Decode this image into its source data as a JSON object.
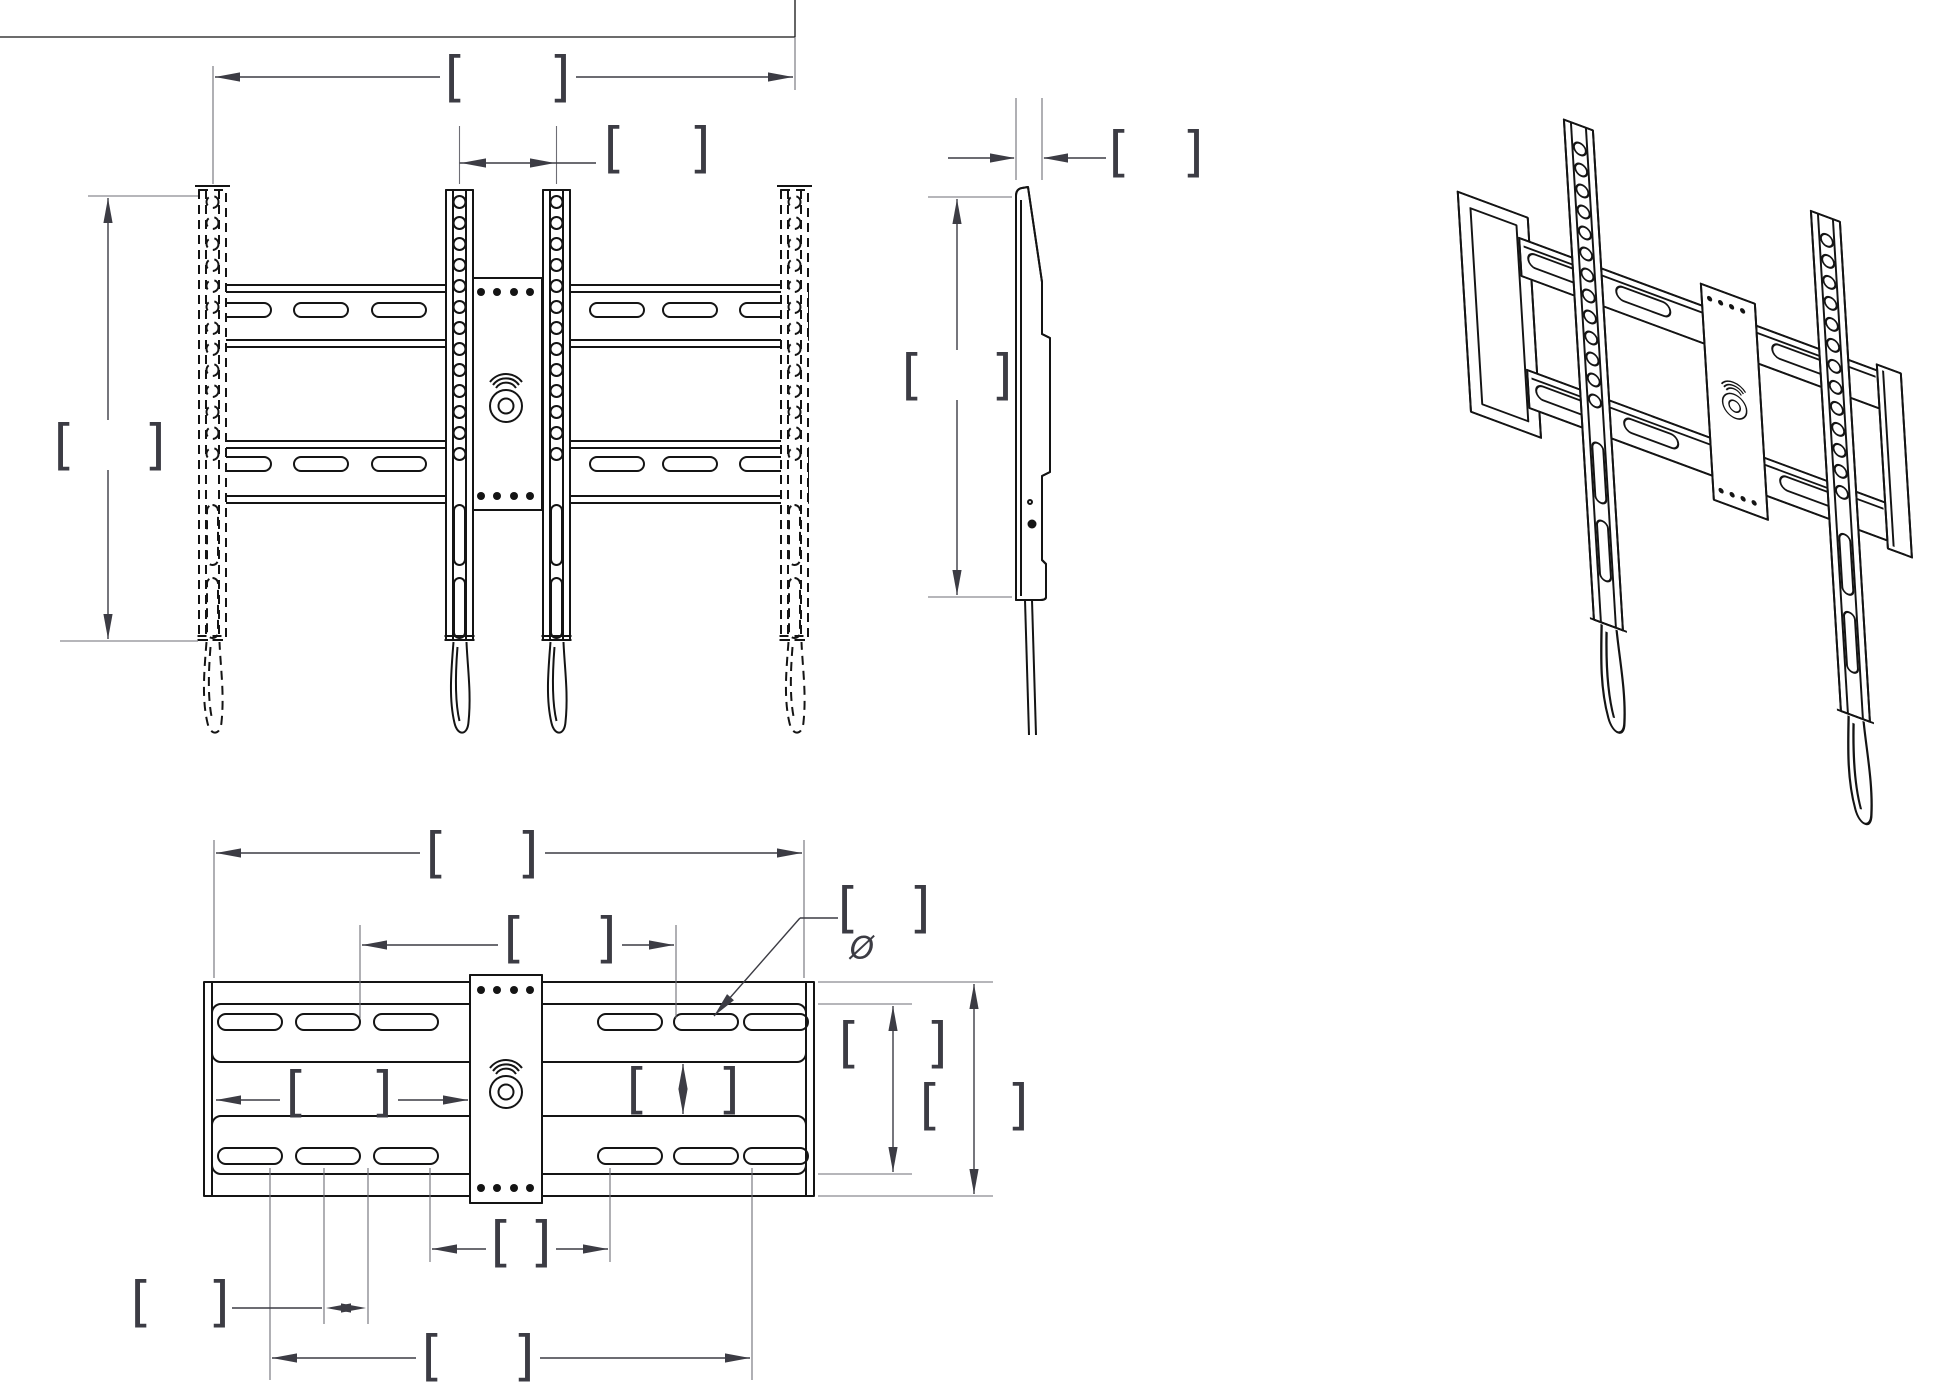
{
  "drawing": {
    "background": "#ffffff",
    "colors": {
      "object_line": "#141414",
      "dimension_line": "#3c3c44",
      "extension_line": "#6e6e76"
    },
    "symbols": {
      "bracket_open": "[",
      "bracket_close": "]",
      "diameter": "Ø"
    },
    "views": [
      {
        "id": "front",
        "label": "front-view"
      },
      {
        "id": "side",
        "label": "side-view"
      },
      {
        "id": "isometric",
        "label": "isometric-view"
      },
      {
        "id": "bottom",
        "label": "bottom-plan-view"
      }
    ],
    "dimensions": [
      {
        "id": "front-overall-rail-spacing",
        "view": "front",
        "orientation": "horizontal",
        "value": ""
      },
      {
        "id": "front-center-rail-spacing",
        "view": "front",
        "orientation": "horizontal",
        "value": ""
      },
      {
        "id": "front-rail-height",
        "view": "front",
        "orientation": "vertical",
        "value": ""
      },
      {
        "id": "side-thickness",
        "view": "side",
        "orientation": "horizontal",
        "value": ""
      },
      {
        "id": "side-height",
        "view": "side",
        "orientation": "vertical",
        "value": ""
      },
      {
        "id": "bottom-overall-width",
        "view": "bottom",
        "orientation": "horizontal",
        "value": ""
      },
      {
        "id": "bottom-slot-span",
        "view": "bottom",
        "orientation": "horizontal",
        "value": ""
      },
      {
        "id": "bottom-left-cavity-width",
        "view": "bottom",
        "orientation": "horizontal",
        "value": ""
      },
      {
        "id": "bottom-right-cavity-height",
        "view": "bottom",
        "orientation": "vertical",
        "value": ""
      },
      {
        "id": "bottom-inner-height",
        "view": "bottom",
        "orientation": "vertical",
        "value": ""
      },
      {
        "id": "bottom-overall-height",
        "view": "bottom",
        "orientation": "vertical",
        "value": ""
      },
      {
        "id": "bottom-slot-diameter-callout",
        "view": "bottom",
        "orientation": "leader",
        "value": "",
        "prefix": "Ø"
      },
      {
        "id": "bottom-slot-pitch",
        "view": "bottom",
        "orientation": "horizontal",
        "value": ""
      },
      {
        "id": "bottom-lower-span",
        "view": "bottom",
        "orientation": "horizontal",
        "value": ""
      }
    ]
  }
}
